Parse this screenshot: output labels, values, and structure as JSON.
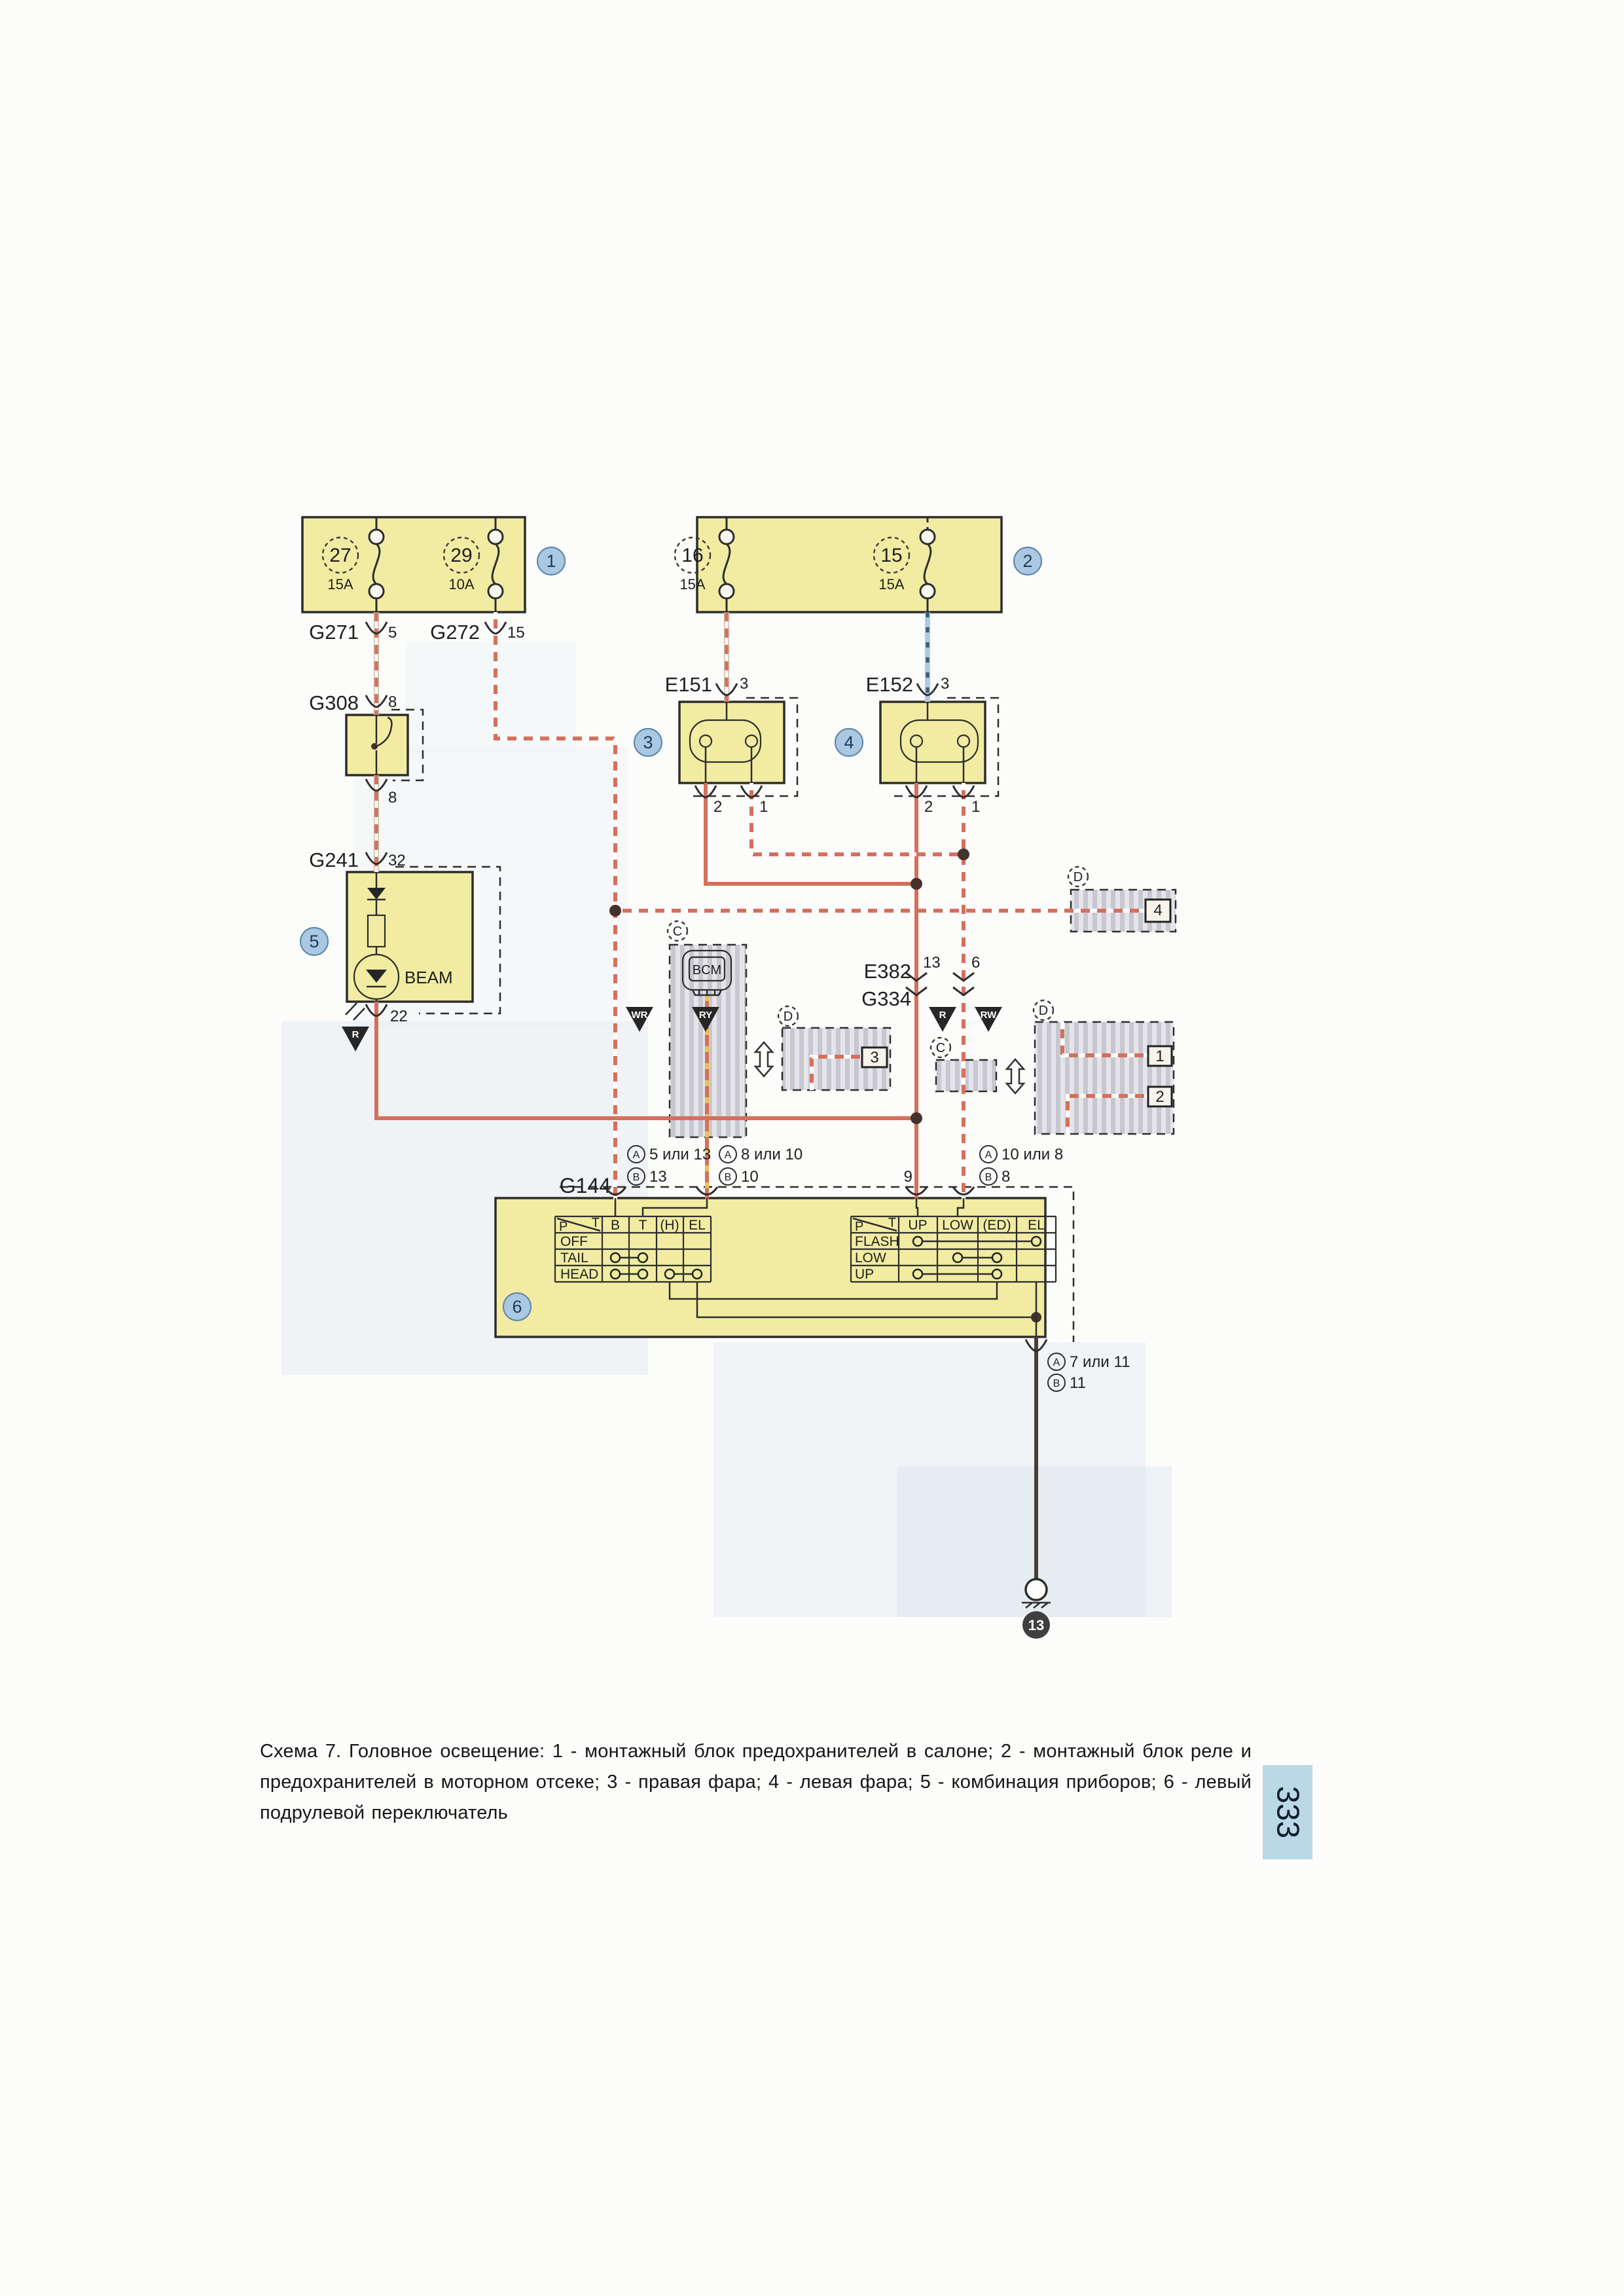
{
  "page": {
    "caption": "Схема 7. Головное освещение: 1 - монтажный блок предохранителей в салоне; 2 - монтажный блок реле и предохранителей в моторном отсеке; 3 - правая фара; 4 - левая фара; 5 - комбинация приборов; 6 - левый подрулевой переключатель",
    "number": "333"
  },
  "callouts": {
    "c1": "1",
    "c2": "2",
    "c3": "3",
    "c4": "4",
    "c5": "5",
    "c6": "6"
  },
  "fusebox1": {
    "fuse_left_num": "27",
    "fuse_left_amp": "15A",
    "fuse_right_num": "29",
    "fuse_right_amp": "10A"
  },
  "fusebox2": {
    "fuse_left_num": "16",
    "fuse_left_amp": "15A",
    "fuse_right_num": "15",
    "fuse_right_amp": "15A"
  },
  "connectors": {
    "g271": "G271",
    "g271_pin": "5",
    "g272": "G272",
    "g272_pin": "15",
    "g308": "G308",
    "g308_pin_top": "8",
    "g308_pin_bottom": "8",
    "g241": "G241",
    "g241_pin": "32",
    "e151": "E151",
    "e151_pin_top": "3",
    "e151_pin2": "2",
    "e151_pin1": "1",
    "e152": "E152",
    "e152_pin_top": "3",
    "e152_pin2": "2",
    "e152_pin1": "1",
    "e382": "E382",
    "g334": "G334",
    "e382_pin_left": "13",
    "e382_pin_right": "6",
    "g144": "G144",
    "g144_w1_a": "5 или 13",
    "g144_w1_b": "13",
    "g144_w2_a": "8 или 10",
    "g144_w2_b": "10",
    "g144_w3": "9",
    "g144_w4_a": "10 или 8",
    "g144_w4_b": "8",
    "exit_a": "7 или 11",
    "exit_b": "11",
    "ground": "13",
    "label_a": "A",
    "label_b": "B"
  },
  "wire_codes": {
    "beam_out": "R",
    "g272_wire": "WR",
    "bcm_wire": "RY",
    "high_wire": "R",
    "low_wire": "RW"
  },
  "labels": {
    "beam": "BEAM",
    "bcm": "BCM"
  },
  "variants": {
    "c": "C",
    "d": "D",
    "t1": "1",
    "t2": "2",
    "t3": "3",
    "t4": "4"
  },
  "switch_tables": {
    "corner_p": "P",
    "corner_t": "T",
    "left": {
      "cols": [
        "B",
        "T",
        "(H)",
        "EL"
      ],
      "rows": [
        "OFF",
        "TAIL",
        "HEAD"
      ]
    },
    "right": {
      "cols": [
        "UP",
        "LOW",
        "(ED)",
        "EL"
      ],
      "rows": [
        "FLASH",
        "LOW",
        "UP"
      ]
    }
  }
}
